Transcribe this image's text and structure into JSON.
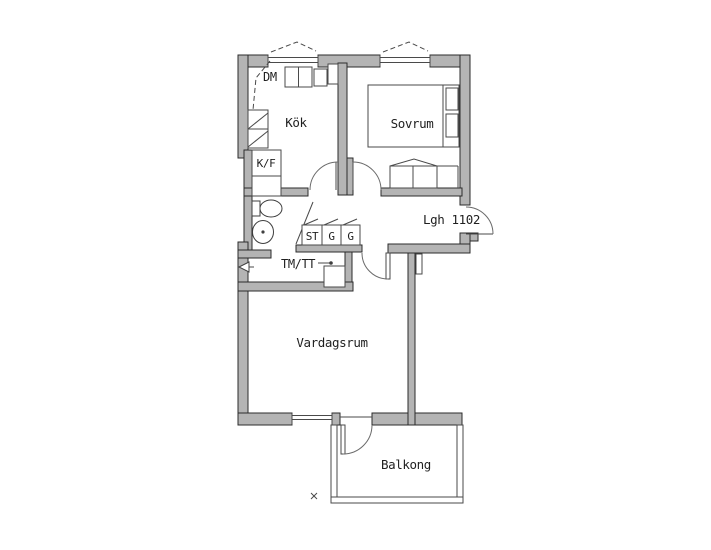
{
  "floorplan": {
    "apartment_label": "Lgh 1102",
    "rooms": [
      {
        "id": "kitchen",
        "label": "Kök"
      },
      {
        "id": "bedroom",
        "label": "Sovrum"
      },
      {
        "id": "living_room",
        "label": "Vardagsrum"
      },
      {
        "id": "balcony",
        "label": "Balkong"
      }
    ],
    "fixtures": {
      "dishwasher_label": "DM",
      "fridge_freezer_label": "K/F",
      "cleaning_closet_label": "ST",
      "wardrobe1_label": "G",
      "wardrobe2_label": "G",
      "washer_dryer_label": "TM/TT"
    },
    "colors": {
      "background": "#ffffff",
      "wall_fill": "#b4b4b4",
      "wall_stroke": "#2b2b2b",
      "thin_line": "#4a4a4a",
      "text": "#1f1f1f"
    }
  }
}
